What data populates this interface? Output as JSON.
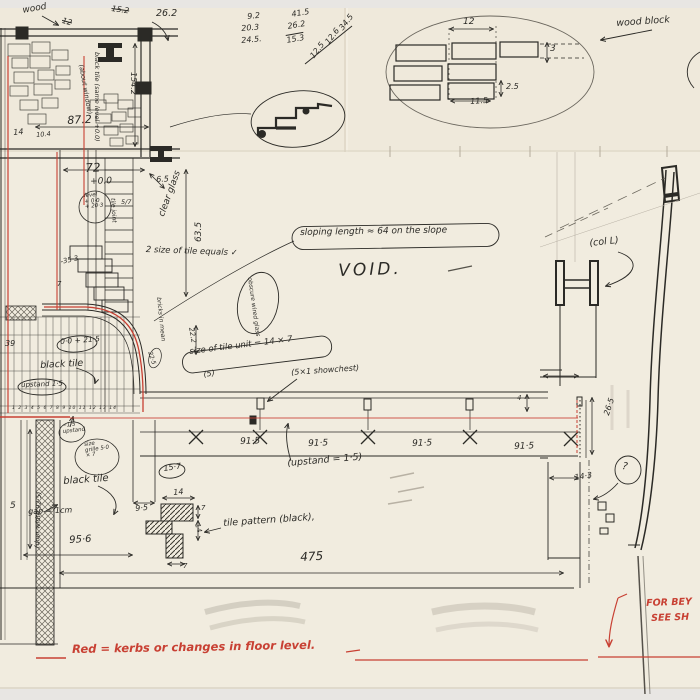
{
  "title": "Hand-drawn architectural working sketch (plan and section with kerb notes)",
  "colors": {
    "paper": "#f1ecdf",
    "backdrop": "#e8e6e3",
    "ink": "#2b2a26",
    "red": "#c84033",
    "pencil": "#b7b0a4"
  },
  "legend": {
    "text": "Red = kerbs or changes in floor level."
  },
  "labels": [
    {
      "name": "note-wood",
      "text": "wood",
      "x": 22,
      "y": 7,
      "rot": -10,
      "size": 9
    },
    {
      "name": "dim-15-2",
      "text": "15.2",
      "x": 112,
      "y": 5,
      "rot": 8,
      "size": 8,
      "cls": "strike"
    },
    {
      "name": "dim-26-2",
      "text": "26.2",
      "x": 156,
      "y": 9,
      "rot": 0,
      "size": 9.5
    },
    {
      "name": "dim-12-struck",
      "text": "12",
      "x": 63,
      "y": 17,
      "rot": 15,
      "size": 8,
      "cls": "strike"
    },
    {
      "name": "calc-col-1",
      "text": "9.2",
      "x": 247,
      "y": 13,
      "rot": -5,
      "size": 8
    },
    {
      "name": "calc-col-2",
      "text": "20.3",
      "x": 241,
      "y": 25,
      "rot": -5,
      "size": 8
    },
    {
      "name": "calc-col-3",
      "text": "24.5.",
      "x": 241,
      "y": 37,
      "rot": -5,
      "size": 8
    },
    {
      "name": "calc-sub-1",
      "text": "41.5",
      "x": 291,
      "y": 11,
      "rot": -10,
      "size": 8
    },
    {
      "name": "calc-sub-2",
      "text": "26.2",
      "x": 287,
      "y": 23,
      "rot": -10,
      "size": 8
    },
    {
      "name": "calc-sub-3",
      "text": "15.3",
      "x": 286,
      "y": 37,
      "rot": -10,
      "size": 8,
      "cls": "overline"
    },
    {
      "name": "calc-diag-1",
      "text": "34.5",
      "x": 338,
      "y": 27,
      "rot": -52,
      "size": 8
    },
    {
      "name": "calc-diag-2",
      "text": "12.6",
      "x": 324,
      "y": 41,
      "rot": -52,
      "size": 8
    },
    {
      "name": "calc-diag-3",
      "text": "12.5",
      "x": 309,
      "y": 55,
      "rot": -52,
      "size": 8
    },
    {
      "name": "note-wood-block",
      "text": "wood block",
      "x": 616,
      "y": 19,
      "rot": -4,
      "size": 9.5
    },
    {
      "name": "wb-dim-12",
      "text": "12",
      "x": 463,
      "y": 18,
      "rot": 0,
      "size": 9
    },
    {
      "name": "wb-dim-3",
      "text": "3",
      "x": 550,
      "y": 45,
      "rot": 0,
      "size": 9
    },
    {
      "name": "wb-dim-2-5",
      "text": "2.5",
      "x": 506,
      "y": 83,
      "rot": 0,
      "size": 8
    },
    {
      "name": "wb-dim-11-5",
      "text": "11.5",
      "x": 470,
      "y": 98,
      "rot": -4,
      "size": 8
    },
    {
      "name": "dim-154-2",
      "text": "154.2",
      "x": 137,
      "y": 72,
      "rot": 90,
      "size": 8
    },
    {
      "name": "note-black-tile-level",
      "text": "black tile (same level +0.0)",
      "x": 100,
      "y": 52,
      "rot": 90,
      "size": 6.5
    },
    {
      "name": "note-about-window",
      "text": "(about window)",
      "x": 84,
      "y": 64,
      "rot": 80,
      "size": 6.5
    },
    {
      "name": "dim-87-2",
      "text": "87.2",
      "x": 67,
      "y": 115,
      "rot": -3,
      "size": 11
    },
    {
      "name": "dim-14",
      "text": "14",
      "x": 13,
      "y": 129,
      "rot": -5,
      "size": 8
    },
    {
      "name": "dim-10-4",
      "text": "10.4",
      "x": 36,
      "y": 132,
      "rot": -5,
      "size": 6.5
    },
    {
      "name": "dim-72",
      "text": "72",
      "x": 85,
      "y": 162,
      "rot": -2,
      "size": 12
    },
    {
      "name": "dim-0-0",
      "text": "+0.0",
      "x": 90,
      "y": 178,
      "rot": -2,
      "size": 9
    },
    {
      "name": "dim-6-5",
      "text": "6.5",
      "x": 156,
      "y": 176,
      "rot": -3,
      "size": 8
    },
    {
      "name": "note-level-circle",
      "text": "level\n+ 0·0\n+ 20·3",
      "x": 84,
      "y": 194,
      "rot": -4,
      "size": 5.5
    },
    {
      "name": "note-tile-joint",
      "text": "tile joint",
      "x": 115,
      "y": 198,
      "rot": 86,
      "size": 6
    },
    {
      "name": "dim-5-7",
      "text": "5/7",
      "x": 121,
      "y": 199,
      "rot": 0,
      "size": 6.5
    },
    {
      "name": "note-clear-glass",
      "text": "clear glass",
      "x": 158,
      "y": 215,
      "rot": -70,
      "size": 9
    },
    {
      "name": "dim-63-5",
      "text": "63.5",
      "x": 195,
      "y": 242,
      "rot": -90,
      "size": 9
    },
    {
      "name": "dim-35-3",
      "text": "-35·3",
      "x": 60,
      "y": 259,
      "rot": -12,
      "size": 7
    },
    {
      "name": "dim-7-mid",
      "text": "7",
      "x": 57,
      "y": 281,
      "rot": 0,
      "size": 7
    },
    {
      "name": "note-2-size",
      "text": "2 size of tile equals ✓",
      "x": 146,
      "y": 246,
      "rot": 2,
      "size": 8.5
    },
    {
      "name": "note-obscure-glass",
      "text": "obscure wired glass",
      "x": 252,
      "y": 277,
      "rot": 82,
      "size": 6
    },
    {
      "name": "note-sloping-length",
      "text": "sloping length ≈ 64 on the slope",
      "x": 300,
      "y": 229,
      "rot": -1,
      "size": 9
    },
    {
      "name": "note-void",
      "text": "VOID.",
      "x": 338,
      "y": 263,
      "rot": -2,
      "size": 17,
      "spacing": 3
    },
    {
      "name": "note-col-l",
      "text": "(col L)",
      "x": 589,
      "y": 239,
      "rot": -6,
      "size": 9.5
    },
    {
      "name": "dim-39",
      "text": "39",
      "x": 5,
      "y": 340,
      "rot": 0,
      "size": 8
    },
    {
      "name": "dim-0-0-21-5",
      "text": "0·0 + 21·5",
      "x": 60,
      "y": 338,
      "rot": -4,
      "size": 7.5
    },
    {
      "name": "note-black-tile-mid",
      "text": "black tile",
      "x": 40,
      "y": 361,
      "rot": -3,
      "size": 9.5
    },
    {
      "name": "note-upstand-mid",
      "text": "upstand 1·5",
      "x": 21,
      "y": 382,
      "rot": -2,
      "size": 7
    },
    {
      "name": "dim-22-2",
      "text": "22.2",
      "x": 194,
      "y": 327,
      "rot": 80,
      "size": 7
    },
    {
      "name": "dim-22-5",
      "text": "22·5",
      "x": 152,
      "y": 351,
      "rot": 72,
      "size": 6
    },
    {
      "name": "note-bricks",
      "text": "bricks in mean",
      "x": 161,
      "y": 297,
      "rot": 84,
      "size": 6
    },
    {
      "name": "note-tile-unit",
      "text": "size of tile unit = 14 × 7",
      "x": 189,
      "y": 348,
      "rot": -7,
      "size": 8.5
    },
    {
      "name": "dim-5-paren",
      "text": "(5)",
      "x": 203,
      "y": 371,
      "rot": -8,
      "size": 8
    },
    {
      "name": "note-showchest",
      "text": "(5×1 showchest)",
      "x": 291,
      "y": 369,
      "rot": -4,
      "size": 8
    },
    {
      "name": "grid-numbers",
      "text": "1 2 3 4 5 6 7 8 9 10 11 12 13 14",
      "x": 12,
      "y": 407,
      "rot": 0,
      "size": 4.5,
      "spacing": 1
    },
    {
      "name": "dim-91-5-1",
      "text": "91·5",
      "x": 240,
      "y": 438,
      "rot": -2,
      "size": 9
    },
    {
      "name": "dim-91-5-2",
      "text": "91·5",
      "x": 308,
      "y": 440,
      "rot": -2,
      "size": 9
    },
    {
      "name": "dim-91-5-3",
      "text": "91·5",
      "x": 412,
      "y": 440,
      "rot": -2,
      "size": 9
    },
    {
      "name": "dim-91-5-4",
      "text": "91·5",
      "x": 514,
      "y": 443,
      "rot": -2,
      "size": 9
    },
    {
      "name": "dim-4",
      "text": "4",
      "x": 517,
      "y": 395,
      "rot": 0,
      "size": 7
    },
    {
      "name": "note-upstand-2",
      "text": "(upstand = 1·5)",
      "x": 287,
      "y": 459,
      "rot": -5,
      "size": 9.5
    },
    {
      "name": "note-upstand-circle",
      "text": "−1·5\nupstand",
      "x": 62,
      "y": 424,
      "rot": -6,
      "size": 5.5
    },
    {
      "name": "note-grille",
      "text": "size\ngrille 5·0\n× 7",
      "x": 84,
      "y": 443,
      "rot": -8,
      "size": 5.5
    },
    {
      "name": "note-black-tile-bottom",
      "text": "black tile",
      "x": 63,
      "y": 477,
      "rot": -4,
      "size": 10
    },
    {
      "name": "note-door-width",
      "text": "(door width 92·5)",
      "x": 34,
      "y": 548,
      "rot": -88,
      "size": 6.5
    },
    {
      "name": "note-gap",
      "text": "gap ≈ 1cm",
      "x": 28,
      "y": 508,
      "rot": -2,
      "size": 8
    },
    {
      "name": "dim-5",
      "text": "5",
      "x": 10,
      "y": 502,
      "rot": 0,
      "size": 9
    },
    {
      "name": "dim-9-5",
      "text": "9·5",
      "x": 135,
      "y": 505,
      "rot": -5,
      "size": 8
    },
    {
      "name": "dim-15-7",
      "text": "15·7",
      "x": 163,
      "y": 465,
      "rot": -8,
      "size": 8
    },
    {
      "name": "dim-14-b",
      "text": "14",
      "x": 173,
      "y": 489,
      "rot": -5,
      "size": 8
    },
    {
      "name": "dim-7-a",
      "text": "7",
      "x": 201,
      "y": 505,
      "rot": 0,
      "size": 7
    },
    {
      "name": "dim-14-c",
      "text": "14",
      "x": 200,
      "y": 523,
      "rot": 75,
      "size": 7
    },
    {
      "name": "dim-7-b",
      "text": "7",
      "x": 183,
      "y": 563,
      "rot": 0,
      "size": 7
    },
    {
      "name": "note-tile-pattern",
      "text": "tile pattern (black),",
      "x": 223,
      "y": 519,
      "rot": -4,
      "size": 9.5
    },
    {
      "name": "dim-95-6",
      "text": "95·6",
      "x": 69,
      "y": 536,
      "rot": -3,
      "size": 10
    },
    {
      "name": "dim-475",
      "text": "475",
      "x": 300,
      "y": 551,
      "rot": -3,
      "size": 12
    },
    {
      "name": "dim-26-5",
      "text": "26·5",
      "x": 603,
      "y": 414,
      "rot": -72,
      "size": 8
    },
    {
      "name": "dim-14-3",
      "text": "14·3",
      "x": 574,
      "y": 474,
      "rot": -8,
      "size": 8
    },
    {
      "name": "mark-question",
      "text": "?",
      "x": 623,
      "y": 462,
      "rot": 10,
      "size": 10
    },
    {
      "name": "note-for-beyond-1",
      "text": "FOR BEY",
      "x": 646,
      "y": 599,
      "rot": -2,
      "size": 9.5,
      "color": "red"
    },
    {
      "name": "note-for-beyond-2",
      "text": "SEE SH",
      "x": 651,
      "y": 614,
      "rot": -2,
      "size": 9.5,
      "color": "red"
    },
    {
      "name": "legend-red",
      "text": "Red = kerbs or changes in floor level.",
      "x": 72,
      "y": 644,
      "rot": -1,
      "size": 11.5,
      "color": "red"
    }
  ]
}
